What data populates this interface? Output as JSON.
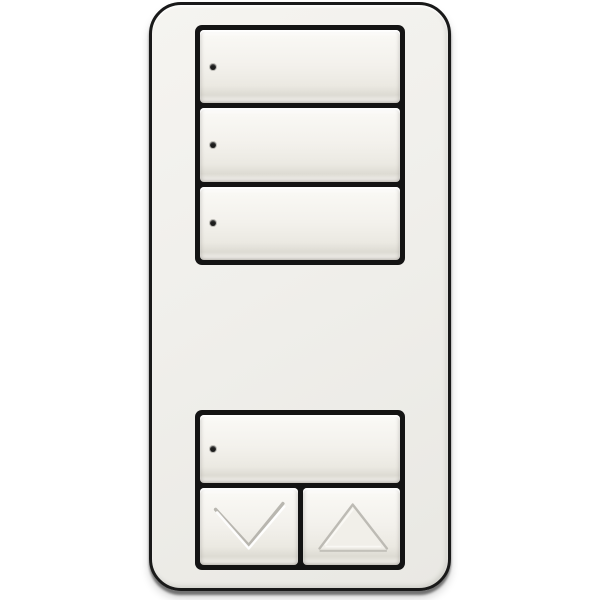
{
  "scene": {
    "background_color": "#ffffff",
    "object": "wall-keypad-dimmer",
    "plate": {
      "color": "#f0efeb",
      "outline_color": "#191919",
      "corner_radius_px": 32
    },
    "colors": {
      "bezel": "#141414",
      "button_face_top": "#ffffff",
      "button_face_bottom": "#e6e4dd",
      "led": "#1c1c1c",
      "glyph_shadow": "#b0aea7",
      "glyph_highlight": "#ffffff"
    },
    "top_bank": {
      "buttons": [
        {
          "id": "scene-button-1",
          "label": "scene 1",
          "led": true
        },
        {
          "id": "scene-button-2",
          "label": "scene 2",
          "led": true
        },
        {
          "id": "scene-button-3",
          "label": "scene 3",
          "led": true
        }
      ]
    },
    "bottom_bank": {
      "main_button": {
        "id": "main-button",
        "label": "main",
        "led": true
      },
      "lower_button": {
        "id": "lower-button",
        "label": "lower",
        "icon": "chevron-down-icon"
      },
      "raise_button": {
        "id": "raise-button",
        "label": "raise",
        "icon": "triangle-up-icon"
      }
    }
  }
}
